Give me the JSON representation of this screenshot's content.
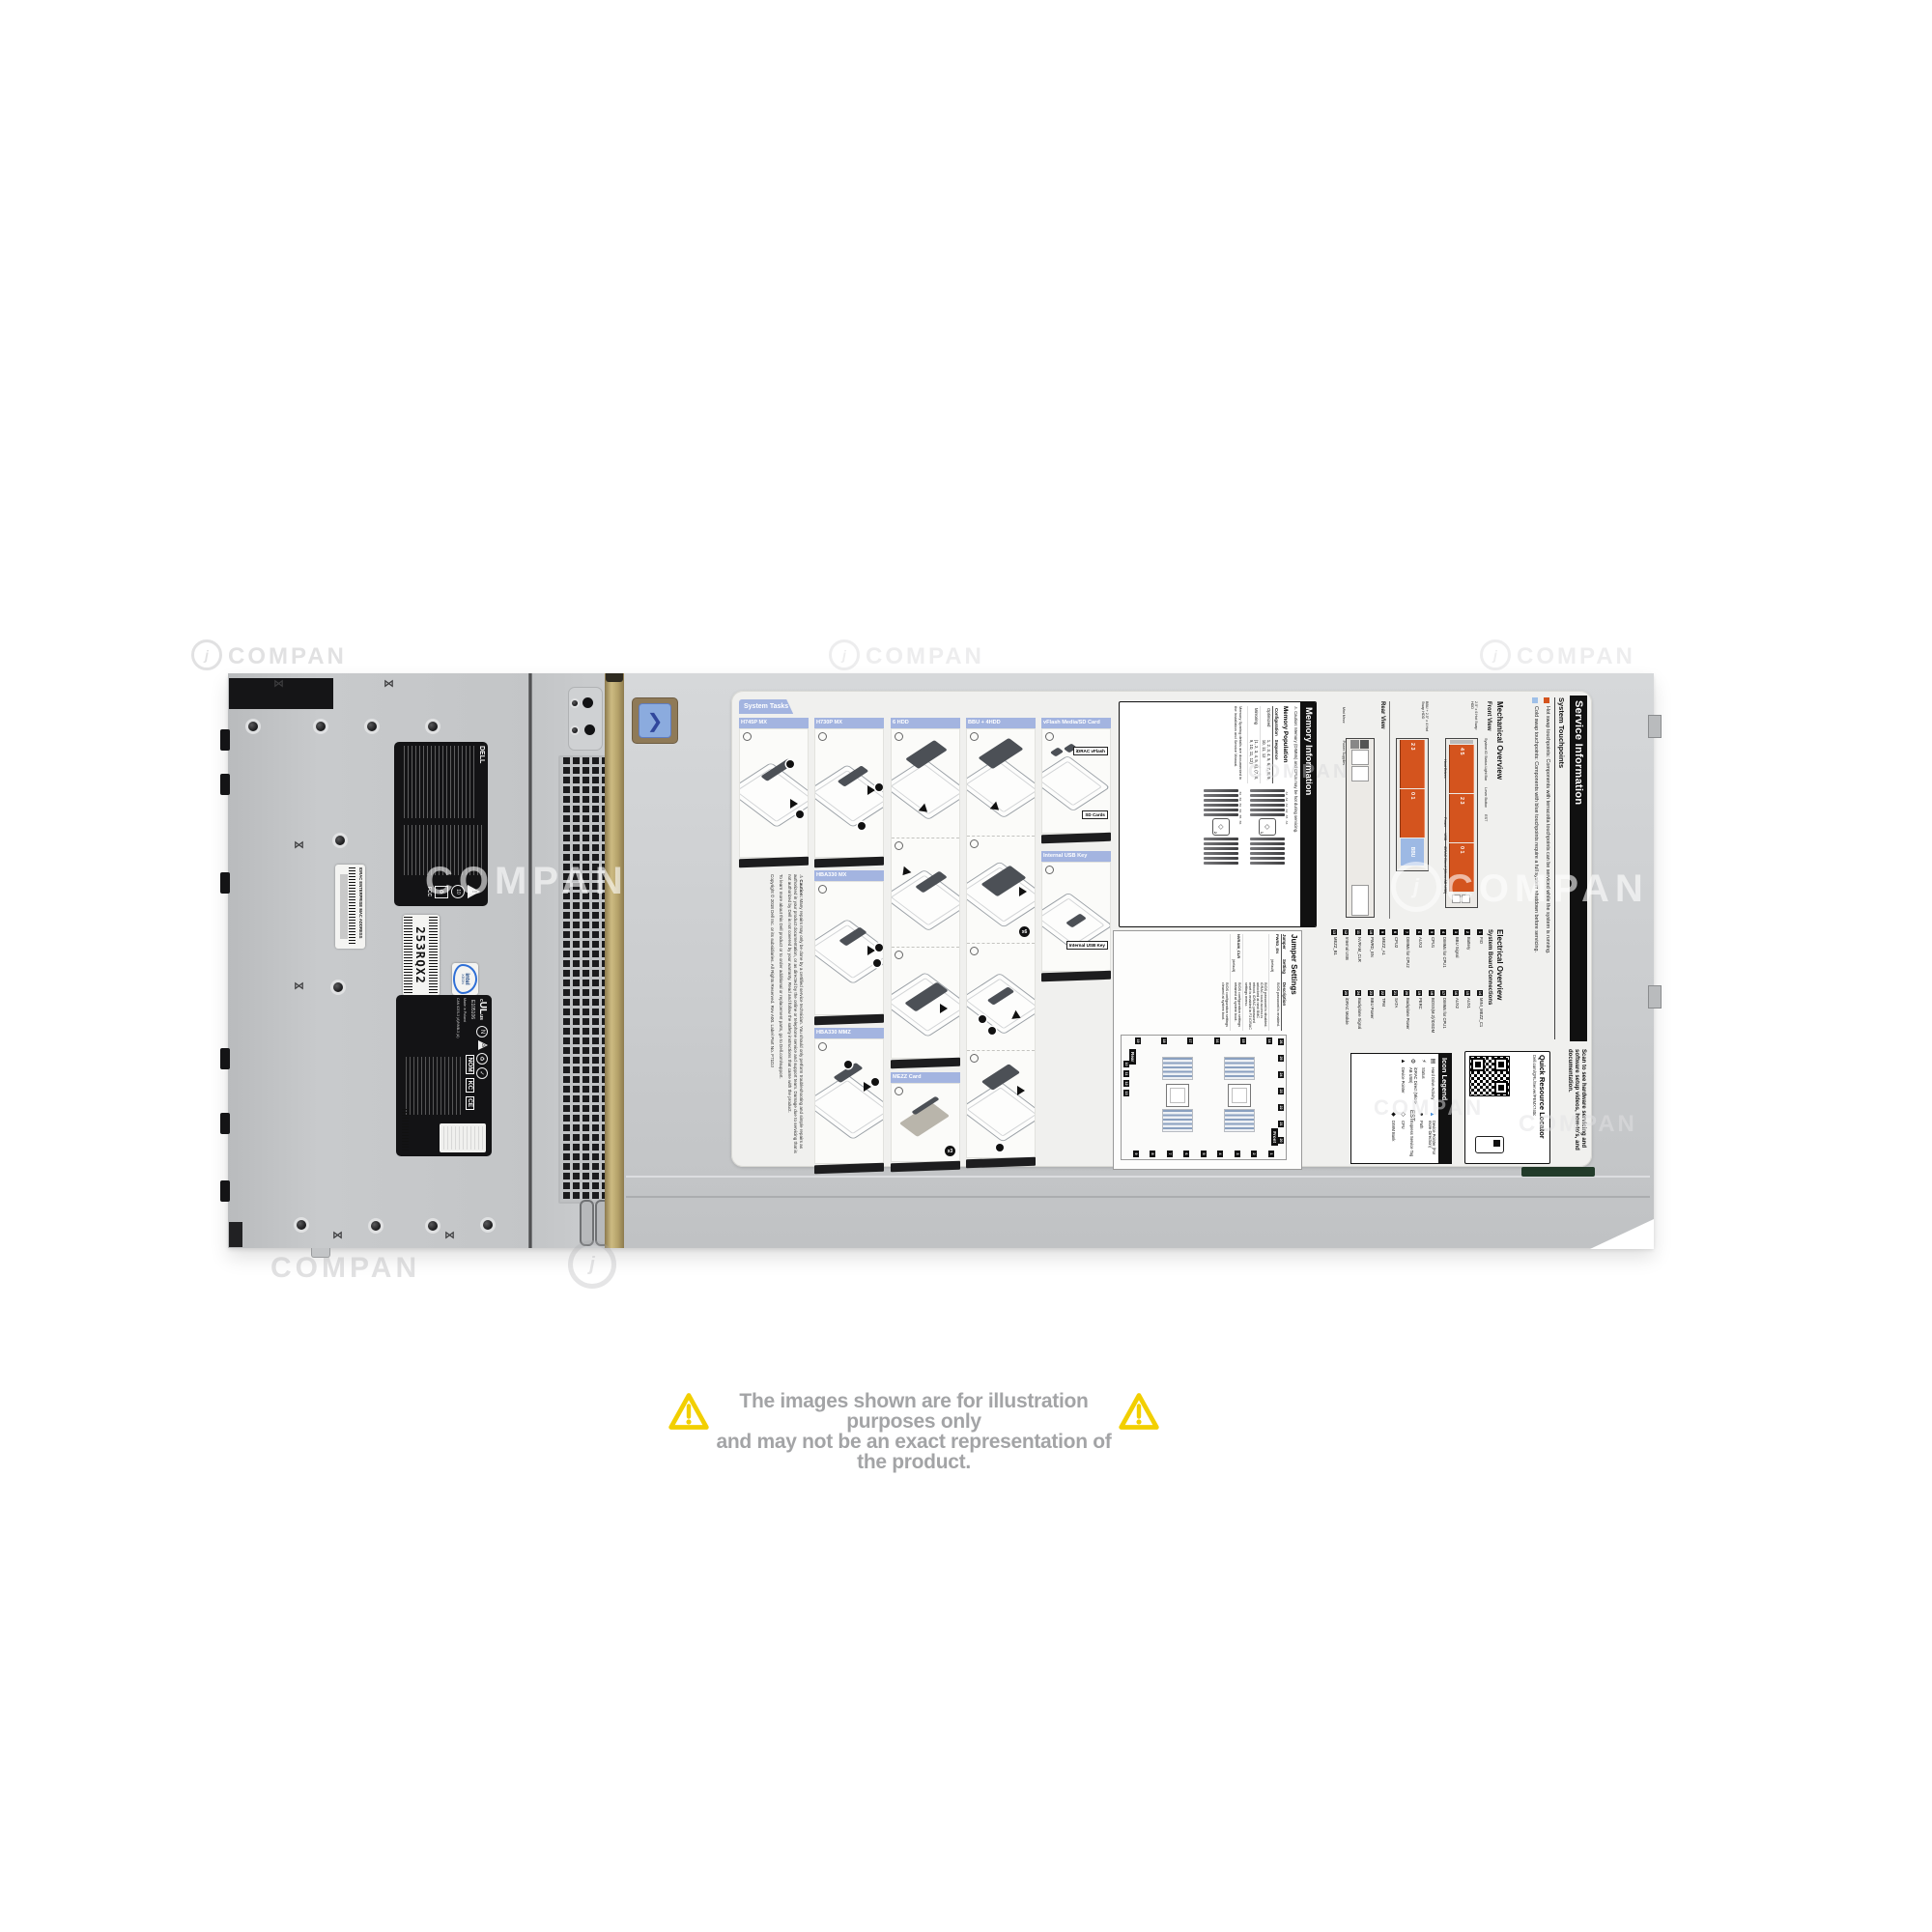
{
  "watermark": {
    "text": "COMPAN",
    "logo_letter": "j"
  },
  "disclaimer": {
    "line1": "The images shown are for illustration purposes only",
    "line2": "and may not be an exact representation of the product."
  },
  "chassis": {
    "service_tag": "253RQX2",
    "idrac_mac_label": "IDRAC ENTERPRISE MAC ADDRESS",
    "intel_brand": "intel",
    "intel_model": "XEON",
    "reg1_brand": "DELL",
    "reg1_fcc": "FCC",
    "reg2_ul_number": "E105106",
    "reg2_made_in": "Made in Poland",
    "reg2_ices": "CAN ICES-3 (A)/NMB-3 (A)",
    "reg2_marks": [
      "NOM",
      "KC",
      "CE"
    ]
  },
  "label": {
    "system_tasks": {
      "tab": "System Tasks",
      "h745p": "H745P MX",
      "h730p": "H730P MX",
      "hdd6": "6 HDD",
      "bbu4": "BBU + 4HDD",
      "vflash": "vFlash Media/SD Card",
      "hba330mx": "HBA330 MX",
      "hba330mmz": "HBA330 MMZ",
      "usbkey": "Internal USB Key",
      "mezz": "MEZZ Card",
      "callout_idrac_vflash": "iDRAC vFlash",
      "callout_sd_cards": "SD Cards",
      "callout_usb": "Internal USB Key",
      "badge_x6": "x6",
      "badge_x3": "x3"
    },
    "caution": {
      "icon": "⚠",
      "title": "Caution:",
      "body": "Many repairs may only be done by a certified service technician. You should only perform troubleshooting and simple repairs as authorized in your product documentation, or as directed by the online or telephone service and support team. Damage due to servicing that is not authorized by Dell is not covered by your warranty. Read and follow the safety instructions that came with the product.",
      "learn_more": "To learn more about this Dell product or to order additional or replacement parts, go to Dell.com/support.",
      "copyright": "Copyright © 2018 Dell Inc. or its subsidiaries. All Rights Reserved. Rev A00. Label Part No. F71DJ"
    },
    "service_info": {
      "title": "Service Information",
      "subtitle": "System Touchpoints",
      "hot_text": "Hot swap touchpoints: Components with terracotta touchpoints can be serviced while the system is running.",
      "cold_text": "Cold swap touchpoints: Components with blue touchpoints require a full system shutdown before servicing.",
      "hot_color": "#d4541e",
      "cold_color": "#9fc0e8"
    },
    "mechanical": {
      "title": "Mechanical Overview",
      "front_view": "Front View",
      "rear_view": "Rear View",
      "front1_caption": "2.5\" x 6 Hot Swap HDD",
      "front2_caption": "BBU + 2.5\" x 4 Hot Swap HDD",
      "bbu": "BBU",
      "front1_drives": [
        "4 5",
        "2 3",
        "0 1"
      ],
      "front2_drives": [
        "2 3",
        "0 1"
      ],
      "labels_mid": [
        "System ID Status Light Bar",
        "Lever Button",
        "EST"
      ],
      "labels_top": [
        "Power",
        "USB",
        "iDRAC Direct (Micro-AB USB)"
      ],
      "label_drives": "Hard Drives",
      "rear_labels": [
        "Mini Mezz",
        "Power Supplies"
      ]
    },
    "electrical": {
      "title": "Electrical Overview",
      "subtitle": "System Board Connections",
      "items": [
        {
          "n": "1",
          "label": "FIO"
        },
        {
          "n": "2",
          "label": "Battery"
        },
        {
          "n": "3",
          "label": "BBU Signal"
        },
        {
          "n": "4",
          "label": "DIMMs for CPU1"
        },
        {
          "n": "5",
          "label": "CPU1"
        },
        {
          "n": "6",
          "label": "AUX3"
        },
        {
          "n": "7",
          "label": "DIMMs for CPU2"
        },
        {
          "n": "8",
          "label": "CPU2"
        },
        {
          "n": "9",
          "label": "MEZZ_A1"
        },
        {
          "n": "10",
          "label": "PWRD_EN"
        },
        {
          "n": "11",
          "label": "NVRAM_CLR"
        },
        {
          "n": "12",
          "label": "Internal USB"
        },
        {
          "n": "13",
          "label": "MEZZ_B1"
        },
        {
          "n": "14",
          "label": "MINI_MEZZ_C1"
        },
        {
          "n": "15",
          "label": "AUX1"
        },
        {
          "n": "16",
          "label": "AUX2"
        },
        {
          "n": "17",
          "label": "DIMMs for CPU1"
        },
        {
          "n": "18",
          "label": "BOSS(M.2)/IDSDM"
        },
        {
          "n": "19",
          "label": "PERC"
        },
        {
          "n": "20",
          "label": "Backplane Power"
        },
        {
          "n": "21",
          "label": "SATA"
        },
        {
          "n": "22",
          "label": "TPM"
        },
        {
          "n": "23",
          "label": "BBU Power"
        },
        {
          "n": "24",
          "label": "Backplane Signal"
        },
        {
          "n": "25",
          "label": "iDRAC Module"
        }
      ]
    },
    "memory": {
      "title": "Memory Information",
      "caution_icon": "⚠",
      "caution": "Caution: Memory (DIMMs) and CPUs may be hot during servicing.",
      "population": "Memory Population",
      "col_config": "Configuration",
      "col_seq": "Sequence",
      "rows": [
        {
          "config": "Optimized",
          "seq": "1, 2, 3, 4, 5, 6, 7, 8, 9, 10, 11, 12"
        },
        {
          "config": "Mirroring",
          "seq": "(1, 2, 3, 4, 5, 6), (7, 8, 9, 10, 11, 12)"
        }
      ],
      "note": "Memory Sparing details are documented in the Installation and Service Manual.",
      "dimm_a_left": [
        "A1",
        "A2",
        "A3",
        "A4",
        "A5",
        "A6"
      ],
      "dimm_a_right": [
        "A7",
        "A8",
        "A9",
        "A10",
        "A11",
        "A12"
      ],
      "dimm_b_left": [
        "B1",
        "B2",
        "B3",
        "B4",
        "B5",
        "B6"
      ],
      "dimm_b_right": [
        "B7",
        "B8",
        "B9",
        "B10",
        "B11",
        "B12"
      ],
      "cpu_glyph": "◇",
      "cpu1": "1",
      "cpu2": "2"
    },
    "jumpers": {
      "title": "Jumper Settings",
      "col_jumper": "Jumper",
      "col_setting": "Setting",
      "col_desc": "Description",
      "default_tag": "(default)",
      "row1_name": "PWRD_EN",
      "row1_desc_a": "BIOS password is enabled.",
      "row1_desc_b": "BIOS password is disabled. iDRAC local access is unlocked at next BMC reboot. iDRAC password reset is enabled in F2 iDRAC settings menu.",
      "row2_name": "NVRAM_CLR",
      "row2_desc_a": "BIOS configuration settings retained at system boot.",
      "row2_desc_b": "BIOS configuration settings cleared at system boot.",
      "front_chip": "Front",
      "rear_chip": "Rear",
      "callouts_top": [
        "26",
        "25",
        "24",
        "23",
        "22",
        "21",
        "20"
      ],
      "callouts_right": [
        "1",
        "2",
        "3",
        "4",
        "5",
        "6",
        "7",
        "8",
        "9"
      ],
      "callouts_bottom": [
        "10",
        "11",
        "12",
        "13"
      ],
      "callouts_left": [
        "14",
        "15",
        "16",
        "17",
        "18",
        "19"
      ]
    },
    "icon_legend": {
      "title": "Icon Legend",
      "items": [
        {
          "glyph": "▤",
          "label": "Hard Drive Activity"
        },
        {
          "glyph": "⚡",
          "label": "Status"
        },
        {
          "glyph": "⚙",
          "label": "iDRAC Direct (Micro-AB USB)"
        },
        {
          "glyph": "▲",
          "label": "Device Pointer"
        },
        {
          "glyph": "▲",
          "label": "Device Pointer (For more Direction)"
        },
        {
          "glyph": "●",
          "label": "Path"
        },
        {
          "glyph": "EST",
          "label": "Express Service Tag"
        },
        {
          "glyph": "◇",
          "label": "CPU"
        },
        {
          "glyph": "◆",
          "label": "DIMM Bank"
        }
      ]
    },
    "qrl": {
      "title": "Quick Resource Locator",
      "url": "Dell.com/QRL/Server/PEMX740c",
      "scan_text": "Scan to see hardware servicing and software setup videos, how-to's, and documentation."
    }
  }
}
